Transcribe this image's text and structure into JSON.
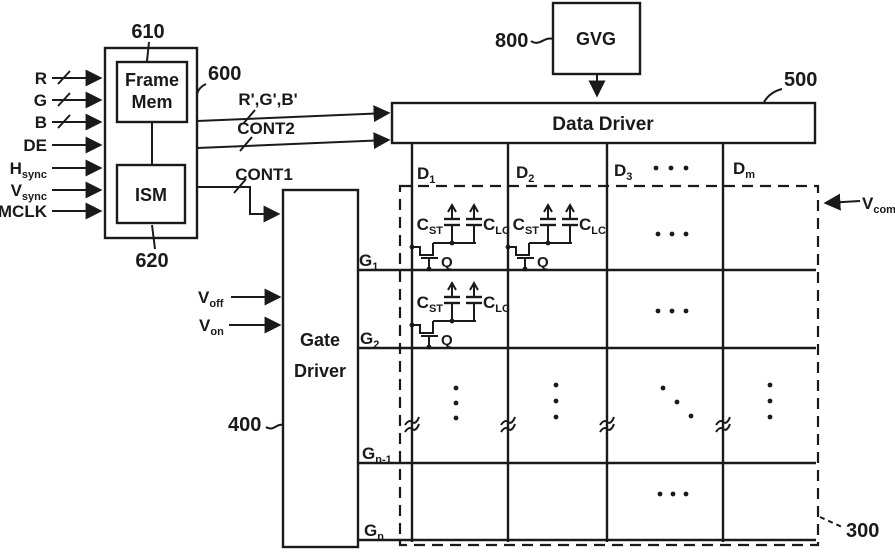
{
  "colors": {
    "ink": "#1a1a1a",
    "background": "#ffffff"
  },
  "reference_numerals": {
    "frame_mem": "610",
    "ism": "620",
    "control_block": "600",
    "gvg": "800",
    "data_driver": "500",
    "gate_driver": "400",
    "panel": "300"
  },
  "input_signals": [
    {
      "main": "R",
      "sub": ""
    },
    {
      "main": "G",
      "sub": ""
    },
    {
      "main": "B",
      "sub": ""
    },
    {
      "main": "DE",
      "sub": ""
    },
    {
      "main": "H",
      "sub": "sync"
    },
    {
      "main": "V",
      "sub": "sync"
    },
    {
      "main": "MCLK",
      "sub": ""
    }
  ],
  "blocks": {
    "frame_mem_line1": "Frame",
    "frame_mem_line2": "Mem",
    "ism": "ISM",
    "gvg": "GVG",
    "data_driver": "Data Driver",
    "gate_driver_line1": "Gate",
    "gate_driver_line2": "Driver"
  },
  "bus_labels": {
    "rgb_prime": "R',G',B'",
    "cont2": "CONT2",
    "cont1": "CONT1"
  },
  "gate_driver_inputs": {
    "voff": {
      "main": "V",
      "sub": "off"
    },
    "von": {
      "main": "V",
      "sub": "on"
    }
  },
  "data_lines": [
    {
      "main": "D",
      "sub": "1"
    },
    {
      "main": "D",
      "sub": "2"
    },
    {
      "main": "D",
      "sub": "3"
    },
    {
      "main": "D",
      "sub": "m"
    }
  ],
  "gate_lines": [
    {
      "main": "G",
      "sub": "1"
    },
    {
      "main": "G",
      "sub": "2"
    },
    {
      "main": "G",
      "sub": "n-1"
    },
    {
      "main": "G",
      "sub": "n"
    }
  ],
  "pixel_labels": {
    "storage_cap": {
      "main": "C",
      "sub": "ST"
    },
    "lc_cap": {
      "main": "C",
      "sub": "LC"
    },
    "tft": "Q"
  },
  "vcom": {
    "main": "V",
    "sub": "com"
  },
  "ellipsis_marks": {
    "horizontal_between_d3_dm": "...",
    "vertical_between_g2_gn1": "...",
    "diagonal_lower_right": "..."
  }
}
